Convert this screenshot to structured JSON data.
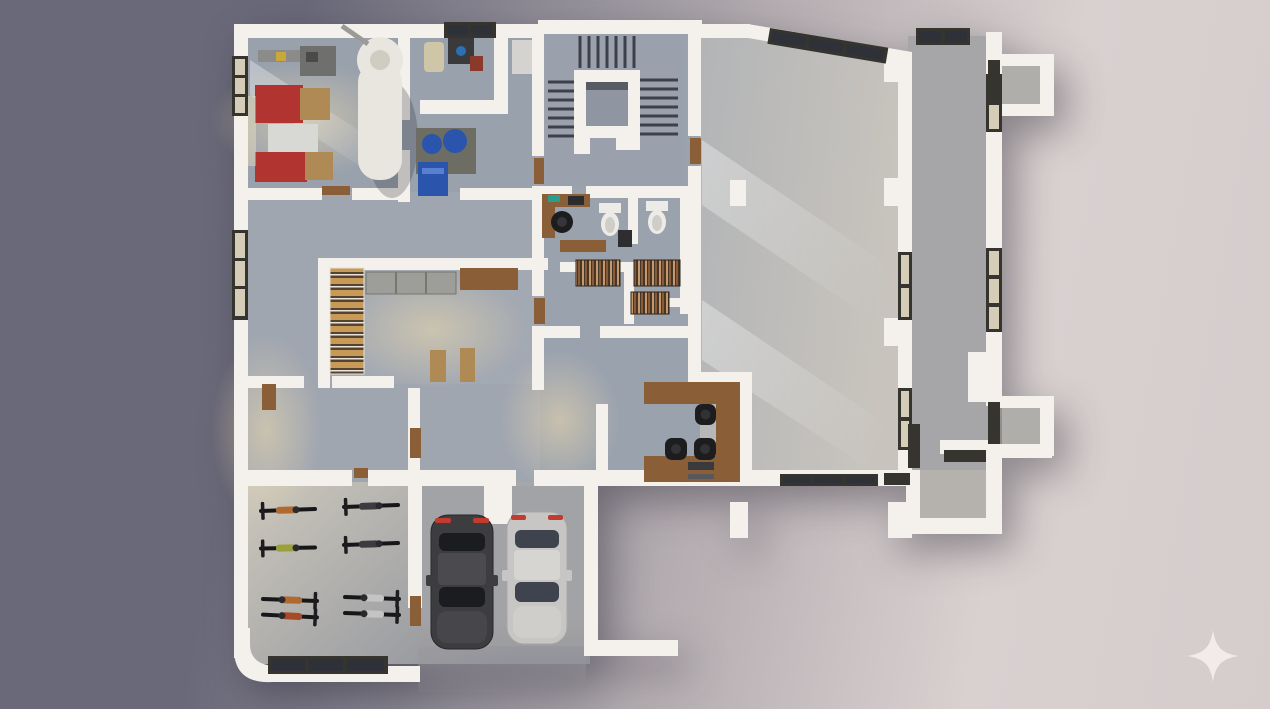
{
  "scene": {
    "description": "3D rendered top-down architectural floor plan of a building ground floor, photorealistic dollhouse view on a gradient backdrop",
    "view": "top-down orthographic",
    "palette": {
      "bg_left": "#6a6979",
      "bg_mid": "#b3acb0",
      "bg_right": "#d9d1d0",
      "wall": "#f4f1ec",
      "wall_shade": "#dcd7cf",
      "floor_cool": "#9aa2ad",
      "floor_mid": "#a7abb3",
      "floor_hall": "#bdbcba",
      "floor_warm": "#cdc3b0",
      "wood": "#8a5f38",
      "wood_light": "#b08a55",
      "frame_dark": "#35342f",
      "glass_warm": "#d6cdb8",
      "glass_cool": "#2e3138",
      "red_unit": "#b23431",
      "blue_unit": "#2b55ad",
      "teal": "#2a9d8f",
      "chair_black": "#1d1d20",
      "car_dark": "#3d3d40",
      "car_silver": "#c7c6c4",
      "taillight": "#c23b30",
      "metal_gray": "#8b8b89",
      "tank_white": "#e9e6df",
      "logo": "#f1ebe9"
    },
    "logo": {
      "name": "sparkle-logo",
      "shape": "four-point-star",
      "position": "bottom-right",
      "color": "#f1ebe9"
    },
    "rooms": [
      {
        "id": "plant-room",
        "area": "top-left",
        "contents": [
          "red industrial unit x2",
          "crate tops x2",
          "white storage tank",
          "gray machine",
          "duct"
        ]
      },
      {
        "id": "equipment-room",
        "area": "top-center-left",
        "contents": [
          "blue pump x2",
          "blue cabinet",
          "beige machine",
          "dark workbench",
          "gray cabinet"
        ]
      },
      {
        "id": "stairwell",
        "area": "top-center",
        "contents": [
          "U-shaped staircase",
          "central landing island"
        ]
      },
      {
        "id": "toilet-room",
        "area": "center",
        "contents": [
          "toilet x2",
          "dark appliance",
          "divider wall"
        ]
      },
      {
        "id": "archive-room",
        "area": "center",
        "contents": [
          "bookshelf x3",
          "wooden counter",
          "small desk with chair",
          "teal laptop"
        ]
      },
      {
        "id": "storage-room",
        "area": "center-left",
        "contents": [
          "pallet rack",
          "gray cabinet row",
          "wooden shelf",
          "bench x2"
        ]
      },
      {
        "id": "reception",
        "area": "center-right",
        "contents": [
          "U-shaped wooden desk",
          "office chair x3",
          "drawer unit"
        ]
      },
      {
        "id": "main-hall",
        "area": "right",
        "contents": [
          "open concrete floor",
          "column",
          "skylight band",
          "window bands"
        ]
      },
      {
        "id": "right-corridor",
        "area": "right-edge",
        "contents": [
          "double wall",
          "window x4",
          "bay box x2"
        ]
      },
      {
        "id": "bike-room",
        "area": "bottom-left",
        "contents": [
          "bicycle x8",
          "bottom window band"
        ]
      },
      {
        "id": "garage",
        "area": "bottom-center",
        "contents": [
          "dark car",
          "silver car",
          "open driveway",
          "L-wall"
        ]
      }
    ],
    "counts": {
      "bicycles": 8,
      "cars": 2,
      "toilets": 2,
      "office_chairs": 4,
      "bookshelves": 3,
      "red_units": 2,
      "blue_units": 3,
      "stair_flights": 3,
      "columns": 4,
      "bay_boxes": 2
    }
  }
}
